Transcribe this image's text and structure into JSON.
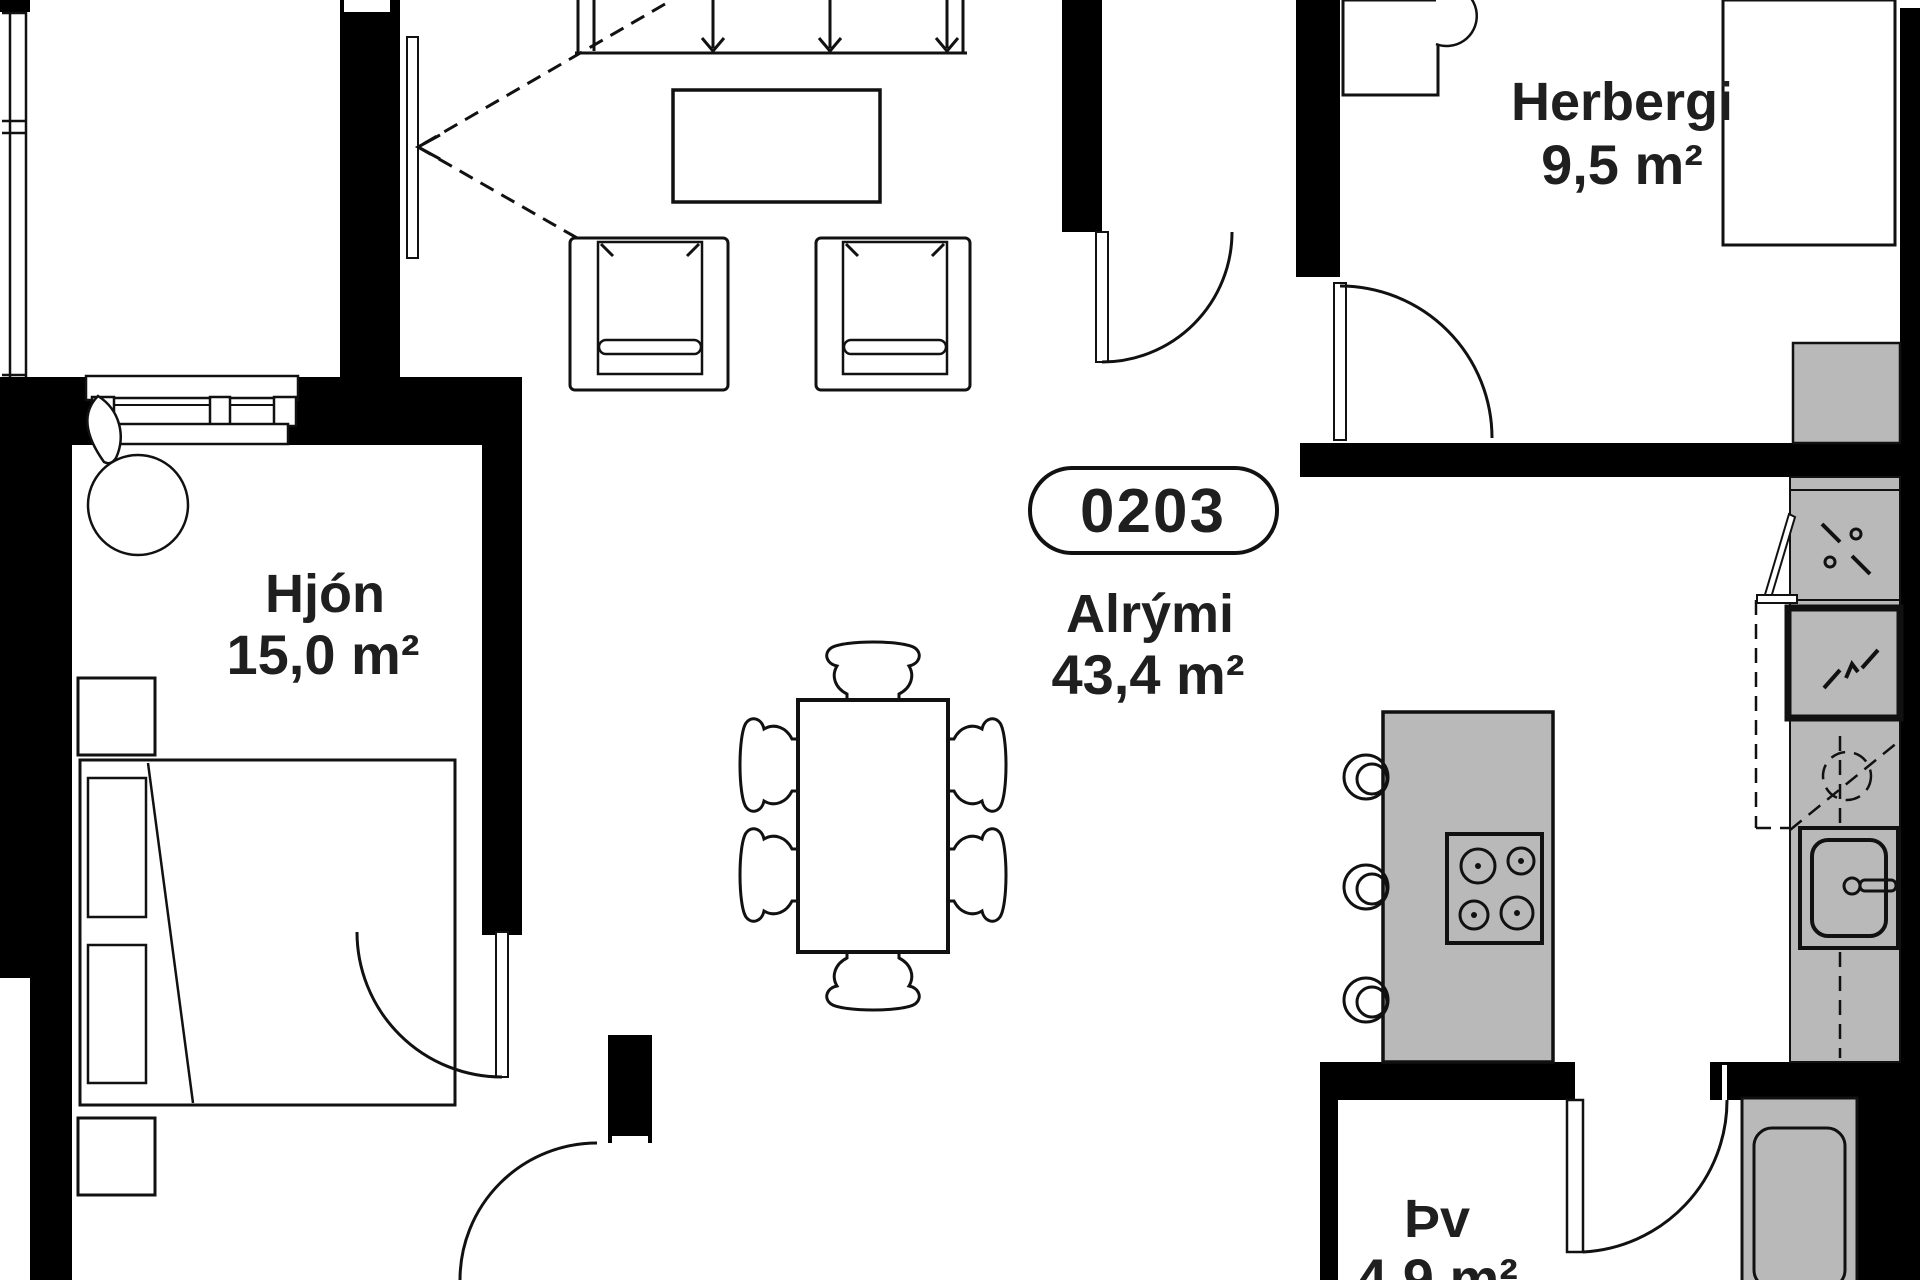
{
  "plan": {
    "badge": "0203",
    "rooms": {
      "hjon": {
        "name": "Hjón",
        "area": "15,0 m²"
      },
      "alrymi": {
        "name": "Alrými",
        "area": "43,4 m²"
      },
      "herbergi": {
        "name": "Herbergi",
        "area": "9,5 m²"
      },
      "thv": {
        "name": "Þv",
        "area": "4,9 m²"
      }
    },
    "colors": {
      "wall": "#000000",
      "fixture_fill": "#b9b9b9",
      "line": "#111111",
      "background": "#ffffff"
    }
  }
}
